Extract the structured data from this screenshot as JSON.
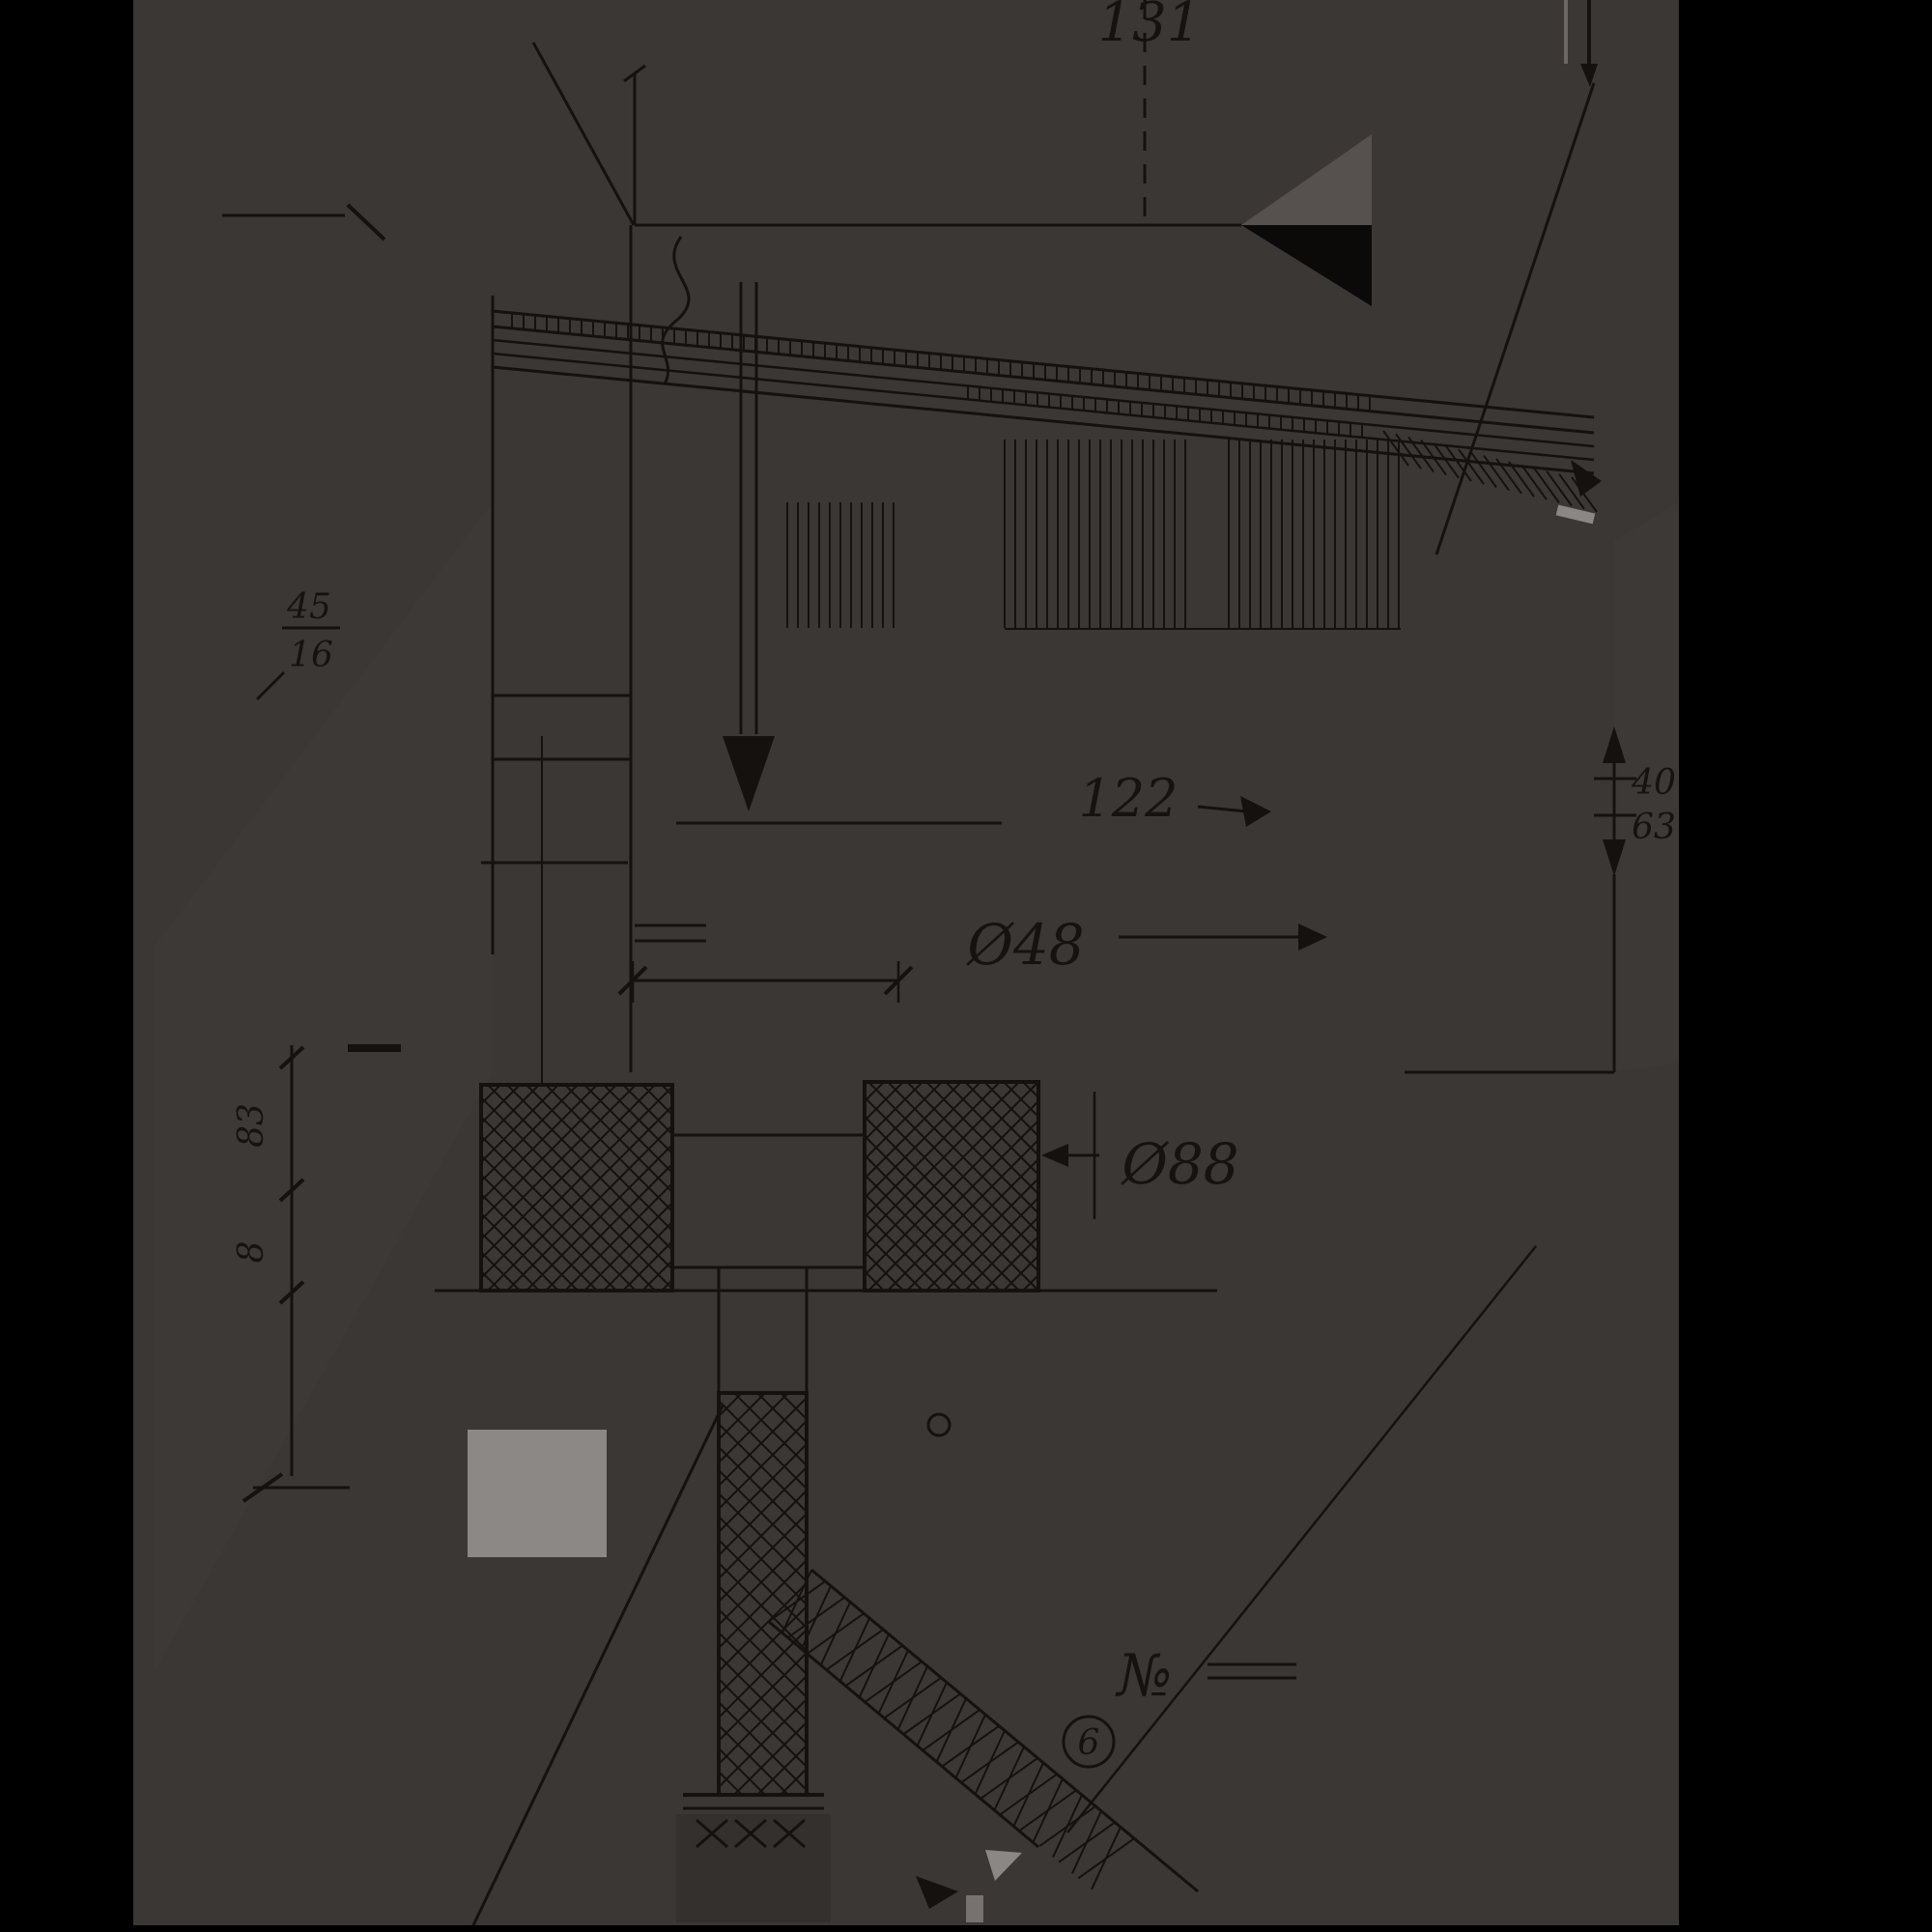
{
  "drawing": {
    "type": "architectural-section-detail",
    "sheet_color": "#3b3734",
    "page_background": "#000000",
    "line_color": "#14110f",
    "accent_gray": "#8a8784",
    "labels": {
      "dim_top": "131",
      "dim_mid": "122",
      "dia_small": "Ø48",
      "dia_large": "Ø88",
      "dim_right_upper": "40",
      "dim_right_lower": "63",
      "left_frac_top": "45",
      "left_frac_bottom": "16",
      "left_dim_upper": "83",
      "left_dim_lower": "8",
      "number_sign": "№",
      "detail_circle": "6"
    }
  }
}
